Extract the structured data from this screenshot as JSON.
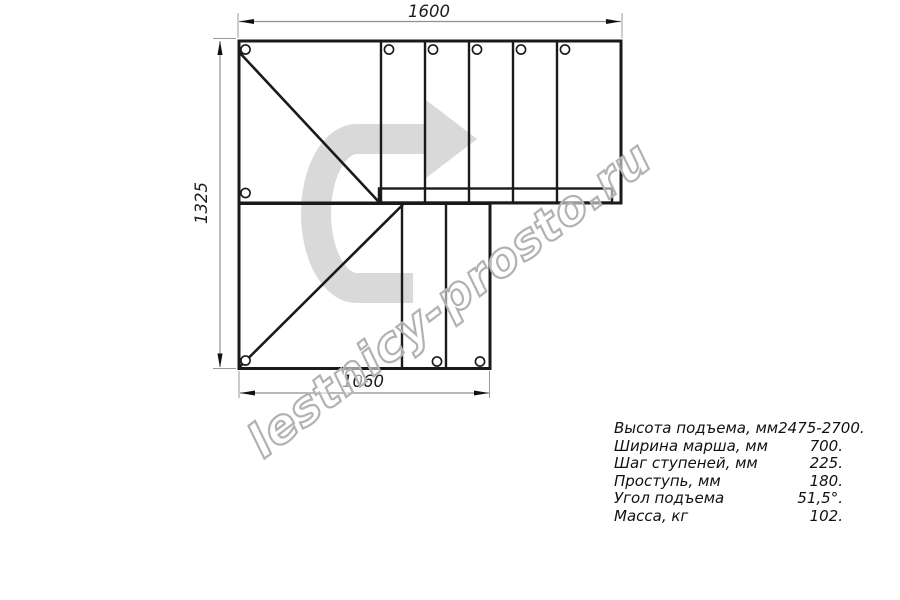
{
  "watermark": {
    "text": "lestnicy-prosto.ru"
  },
  "drawing": {
    "dim_top": "1600",
    "dim_left": "1325",
    "dim_bottom": "1060",
    "line_color": "#1a1a1a",
    "dim_line_color": "#8f8f8f",
    "arrow_color": "#d9d9d9",
    "watermark_outline_color": "#b2b2b2"
  },
  "specs": {
    "rows": [
      {
        "label": "Высота подъема, мм",
        "value": "2475-2700."
      },
      {
        "label": "Ширина марша, мм",
        "value": "700."
      },
      {
        "label": "Шаг ступеней, мм",
        "value": "225."
      },
      {
        "label": "Проступь, мм",
        "value": "180."
      },
      {
        "label": "Угол подъема",
        "value": "51,5°."
      },
      {
        "label": "Масса, кг",
        "value": "102."
      }
    ]
  }
}
